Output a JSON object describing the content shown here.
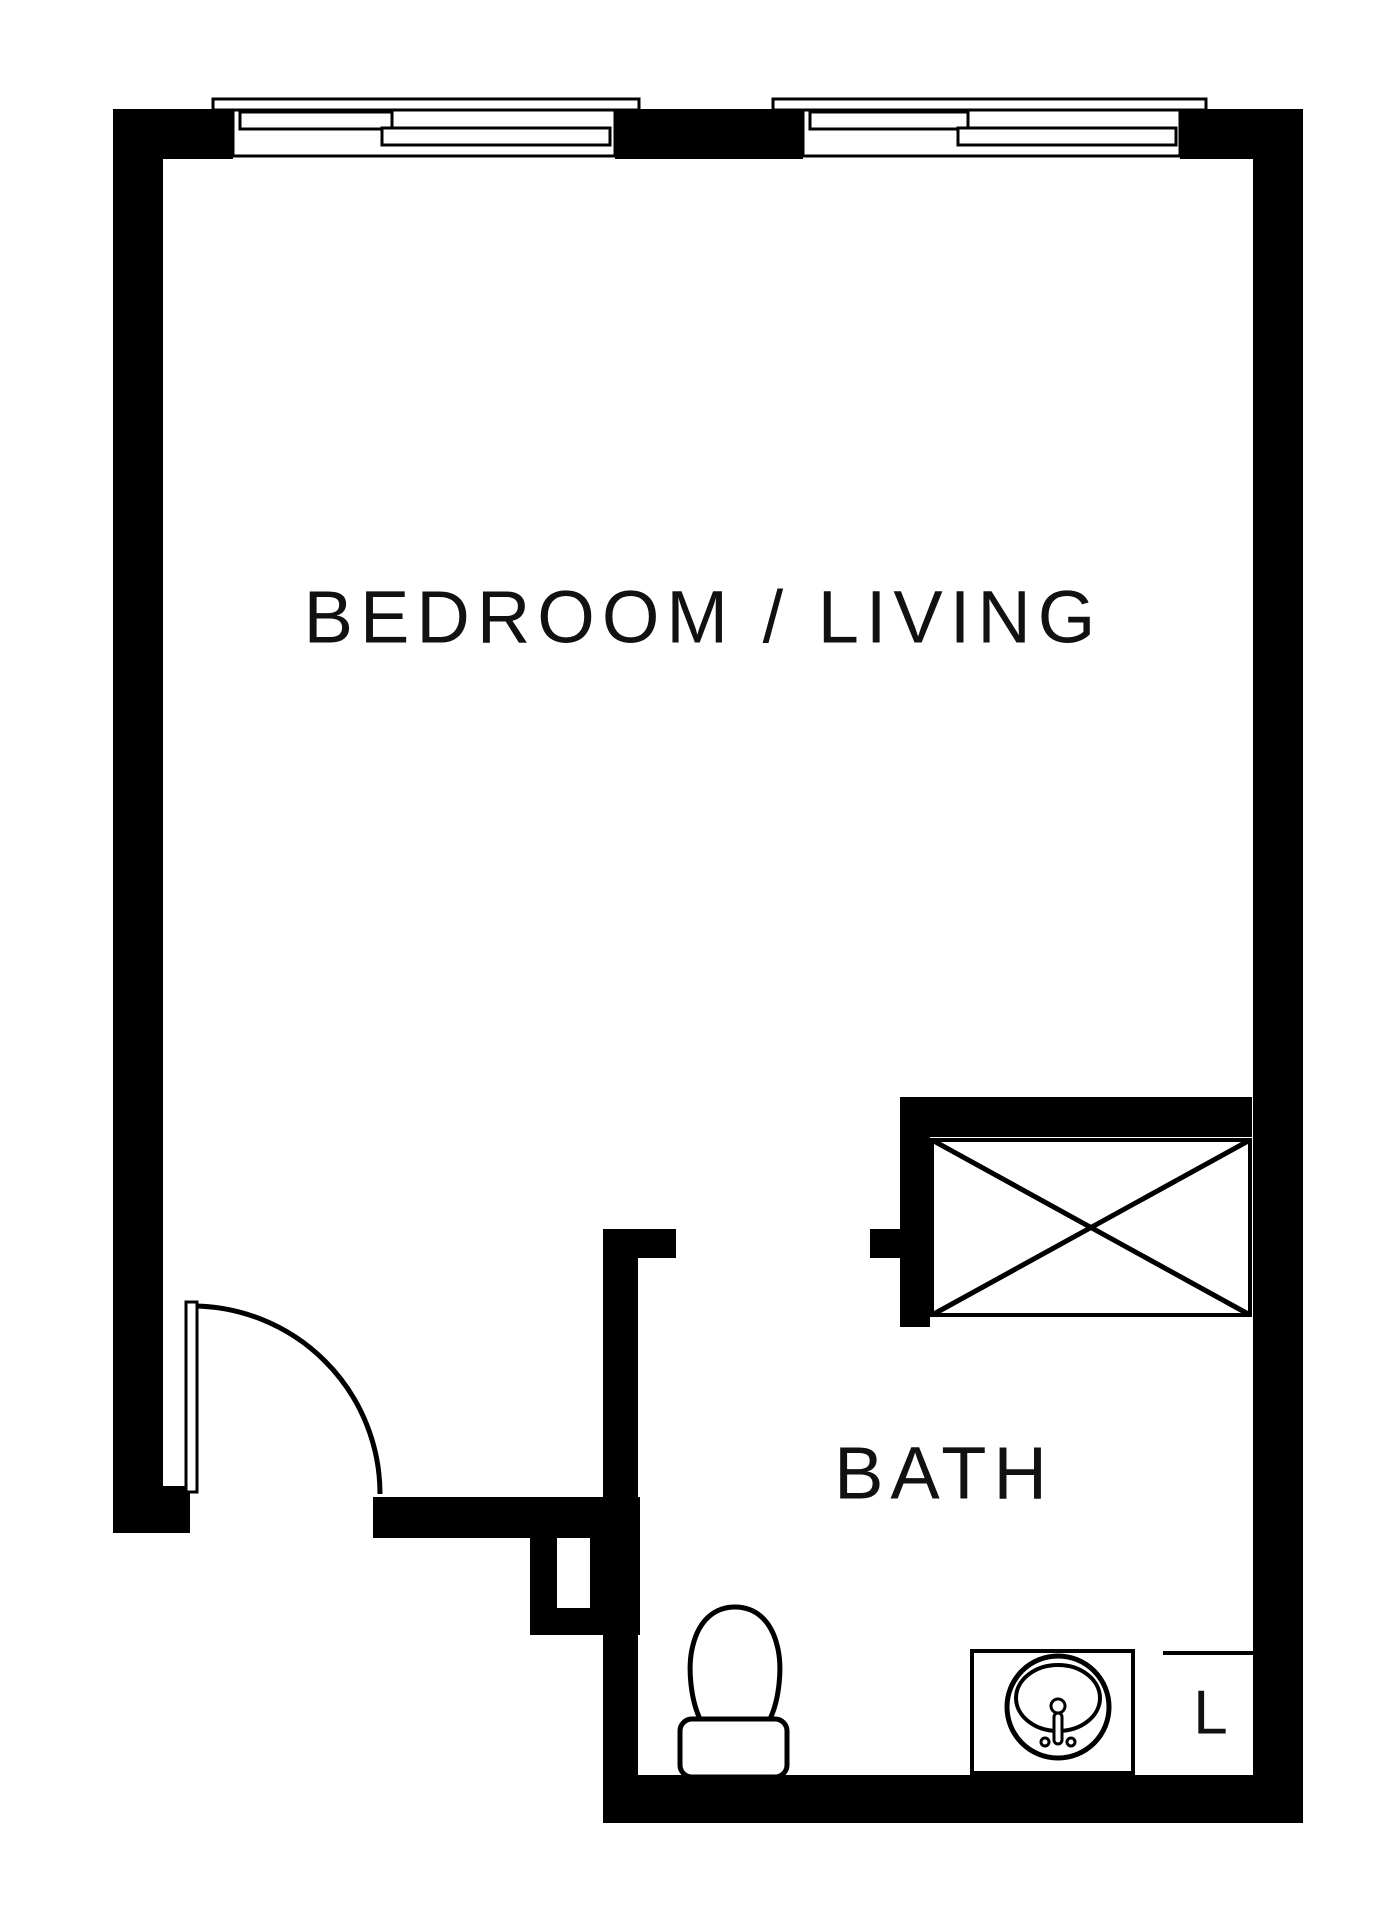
{
  "title": "Studio apartment floor plan",
  "colors": {
    "wall": "#000000",
    "background": "#ffffff",
    "line": "#111111"
  },
  "rooms": {
    "bedroom_living": {
      "label": "BEDROOM / LIVING"
    },
    "bath": {
      "label": "BATH"
    },
    "linen": {
      "label": "L"
    }
  },
  "fixtures": [
    "window",
    "window",
    "entry-door-swing",
    "closet-crossed-box",
    "toilet",
    "sink-vanity",
    "linen-closet"
  ]
}
